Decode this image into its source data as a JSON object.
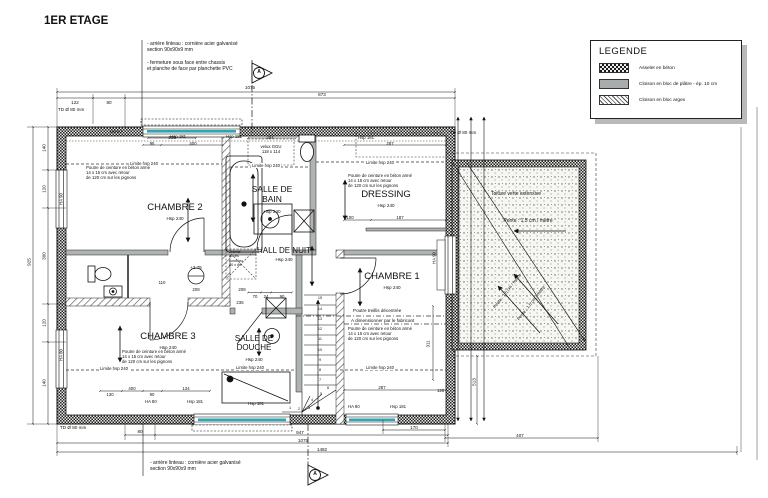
{
  "title": "1ER ETAGE",
  "notes": {
    "top1": "- arrière linteau : cornière acier galvanisé\nsection 90x90x9 mm",
    "top2": "- fermeture sous face entre chassis\net planche de face par planchette PVC",
    "bottom": "- arrière linteau : cornière acier galvanisé\nsection 90x90x9 mm"
  },
  "legend": {
    "title": "LEGENDE",
    "items": [
      {
        "label": "Asselet en béton",
        "pattern": "checker"
      },
      {
        "label": "Cloison en bloc de plâtre - ép. 10 cm",
        "pattern": "gray"
      },
      {
        "label": "Cloison en bloc argex",
        "pattern": "hatch"
      }
    ]
  },
  "rooms": {
    "chambre2": {
      "name": "CHAMBRE 2",
      "hsp": "Hsp 240"
    },
    "bain": {
      "name": "SALLE DE\nBAIN",
      "hsp": "Hsp 240"
    },
    "dressing": {
      "name": "DRESSING",
      "hsp": "Hsp 240"
    },
    "hall": {
      "name": "HALL DE NUIT",
      "hsp": "Hsp 240"
    },
    "chambre1": {
      "name": "CHAMBRE 1",
      "hsp": "Hsp 240"
    },
    "chambre3": {
      "name": "CHAMBRE 3",
      "hsp": "Hsp 240"
    },
    "douche": {
      "name": "SALLE DE\nDOUCHE",
      "hsp": "Hsp 240"
    }
  },
  "annotations": {
    "limite": "Limite hsp 240",
    "poutre": "Poutre de ceinture en béton armé\n14 x 15 cm avec retour\nde 120 cm sur les pignons",
    "treillis": "Poutre treillis décentrée",
    "dimensionner": "A dimensionner par le fabricant",
    "tremie": "Trémie\naccès\ncombles\n80 x 80",
    "velux": "velux GGU\n118 x 114",
    "level": "+2.75",
    "td": "TD Ø 80 mm",
    "section": "A"
  },
  "roof": {
    "name": "Toiture verte extensive",
    "pente": "Pente : 1.5 cm / mètre"
  },
  "walls": {
    "ha90": "HA 90",
    "ha80": "HA 80",
    "hsp181": "Hsp 181"
  },
  "stairs": [
    "1",
    "2",
    "3",
    "4",
    "5",
    "6",
    "7",
    "8",
    "9",
    "10",
    "11",
    "12",
    "13",
    "14",
    "15"
  ],
  "dims": {
    "d122": "122",
    "d80": "80",
    "d873": "873",
    "d1075": "1075",
    "d140": "140",
    "d120": "120",
    "d300": "300",
    "d925": "925",
    "d947": "947",
    "d1482": "1482",
    "d170": "170",
    "d407": "407",
    "d513": "513",
    "d128": "128",
    "d311": "311",
    "d230": "230",
    "d400": "400",
    "d95": "95",
    "d294": "294",
    "d287": "287",
    "d100": "100",
    "d187": "187",
    "d70": "70",
    "d24": "24",
    "d90": "90",
    "d236": "236",
    "d208": "208",
    "d110": "110",
    "d130": "130",
    "d134": "134"
  }
}
